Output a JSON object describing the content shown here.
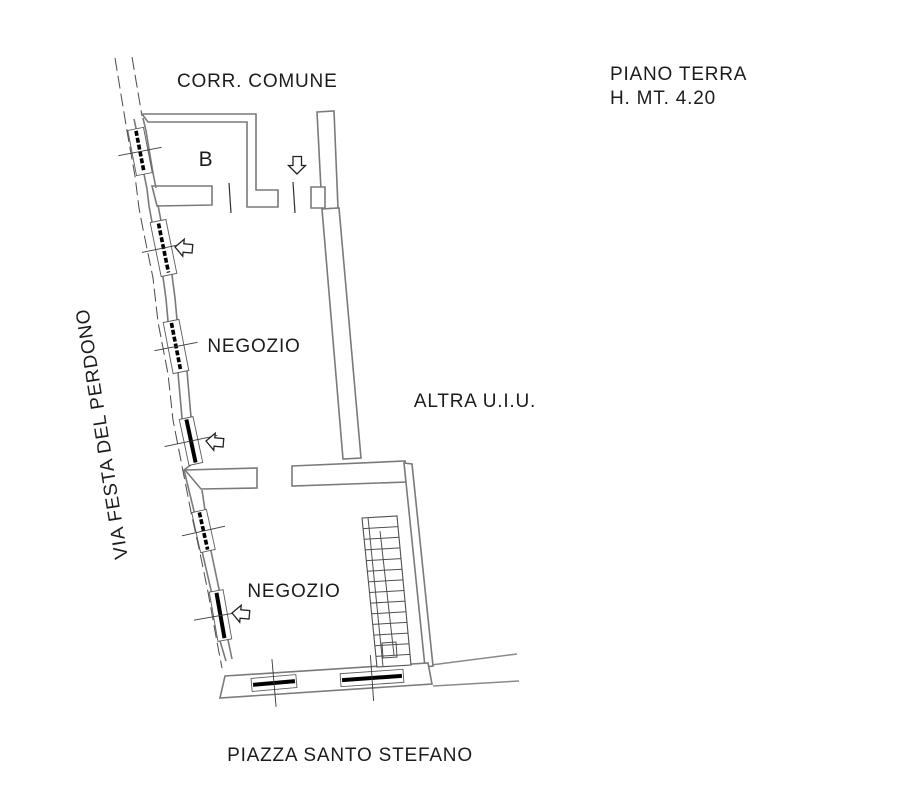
{
  "plan": {
    "header": {
      "floor": "PIANO TERRA",
      "height": "H. MT. 4.20"
    },
    "boundaries": {
      "top": "CORR. COMUNE",
      "left_street": "VIA FESTA DEL PERDONO",
      "bottom_street": "PIAZZA SANTO STEFANO",
      "adjacent_unit": "ALTRA U.I.U."
    },
    "rooms": {
      "room_b": "B",
      "shop_upper": "NEGOZIO",
      "shop_lower": "NEGOZIO"
    },
    "icons": {
      "entrance_arrows": [
        {
          "name": "entrance-arrow-down",
          "direction": "down"
        },
        {
          "name": "entrance-arrow-left-upper",
          "direction": "left"
        },
        {
          "name": "entrance-arrow-left-middle",
          "direction": "left"
        },
        {
          "name": "entrance-arrow-left-lower",
          "direction": "left"
        }
      ]
    },
    "colors": {
      "wall_line": "#7a7a7a",
      "detail_line": "#3a3a3a",
      "opening_bar": "#000000",
      "text": "#1c1c1c",
      "background": "#ffffff"
    }
  }
}
